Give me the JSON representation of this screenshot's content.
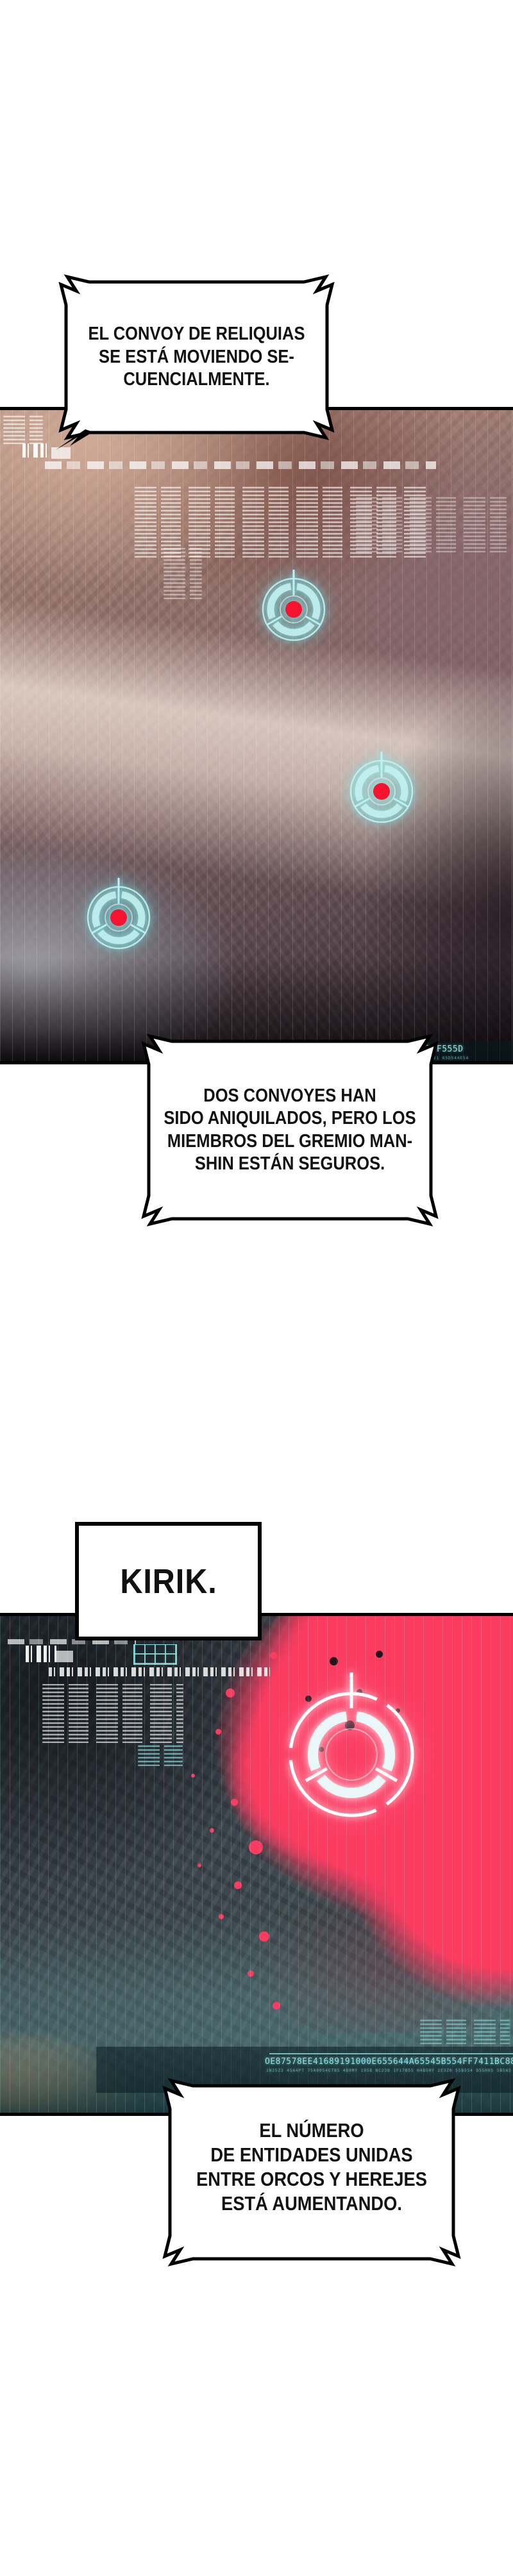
{
  "comic": {
    "bubble1": {
      "lines": [
        "EL CONVOY DE RELIQUIAS",
        "SE ESTÁ MOVIENDO SE-",
        "CUENCIALMENTE."
      ]
    },
    "bubble2": {
      "lines": [
        "DOS CONVOYES HAN",
        "SIDO ANIQUILADOS, PERO LOS",
        "MIEMBROS DEL GREMIO MAN-",
        "SHIN ESTÁN SEGUROS."
      ]
    },
    "kirik": {
      "text": "KIRIK."
    },
    "bubble3": {
      "lines": [
        "EL NÚMERO",
        "DE ENTIDADES UNIDAS",
        "ENTRE ORCOS Y HEREJES",
        "ESTÁ AUMENTANDO."
      ]
    }
  },
  "panel1": {
    "hud": {
      "data_string": "4A12554CCC56555F555D",
      "data_string_secondary": "UAGGODB5554 555B7J23 1F1 321 65D544E54"
    }
  },
  "panel2": {
    "hud": {
      "data_string": "OE87578EE41689191000E655644A65545B554FF7411BC8816889",
      "data_string_secondary": "1N25Z3 45A4PT 75A0054E7B5 4B9MY 1958 NC23B 1F17B55 H4B5HY 2E3Z0 55B554 D55H05 5B5A5 5H7T44 5 5CT55 1 5WH55"
    }
  },
  "colors": {
    "bubble_border": "#000000",
    "reticle_cyan": "#bdf3f4",
    "reticle_red_dot": "#f5132f",
    "alert_pink": "#fb3c61",
    "hud_teal": "#8fdfe2"
  }
}
